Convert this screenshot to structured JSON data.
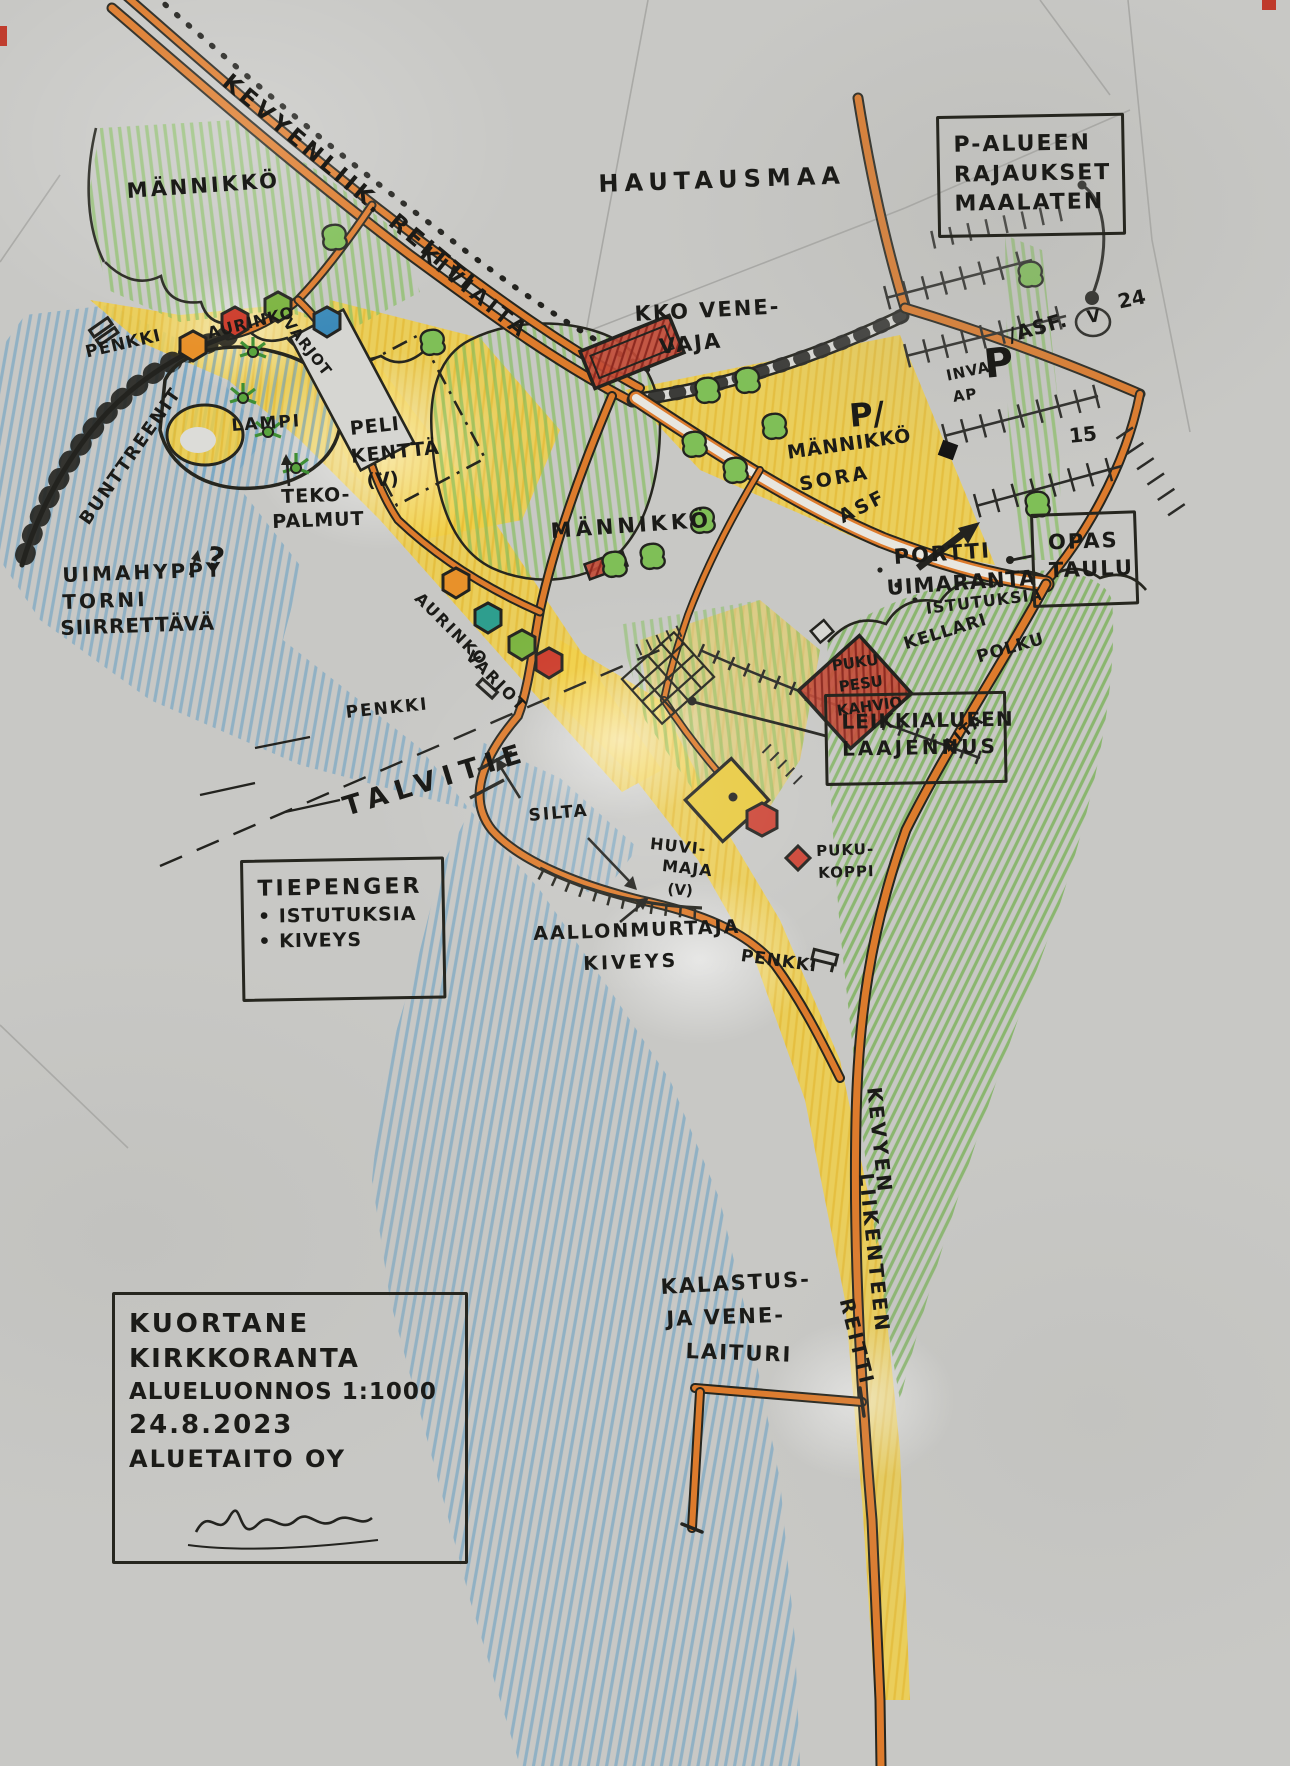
{
  "page": {
    "type": "hand-drawn landscape sketch plan (scanned colour pencil drawing)",
    "language": "Finnish"
  },
  "colors": {
    "paper": "#c8c8c5",
    "road_orange": "#dd7b2c",
    "water_blue": "#6fa3c4",
    "sand_yellow": "#f2cf43",
    "grass_green": "#84bd5c",
    "tree_green": "#7fbf57",
    "building_red": "#bf3a2b",
    "ink_black": "#23231f"
  },
  "labels": [
    {
      "id": "kevyenliik-reitti",
      "text": "KEVYENLIIK. REITTI",
      "x": 233,
      "y": 70,
      "rot": 40,
      "size": 23,
      "ls": 4
    },
    {
      "id": "mannikko-nw",
      "text": "MÄNNIKKÖ",
      "x": 126,
      "y": 180,
      "rot": -4,
      "size": 21,
      "ls": 3
    },
    {
      "id": "hautausmaa",
      "text": "HAUTAUSMAA",
      "x": 598,
      "y": 172,
      "rot": -2,
      "size": 24,
      "ls": 6
    },
    {
      "id": "kiviaita",
      "text": "KIVIAITA",
      "x": 430,
      "y": 242,
      "rot": 39,
      "size": 21,
      "ls": 4
    },
    {
      "id": "kko-venevaja-line1",
      "text": "KKO VENE-",
      "x": 634,
      "y": 303,
      "rot": -3,
      "size": 21,
      "ls": 2
    },
    {
      "id": "kko-venevaja-line2",
      "text": "VAJA",
      "x": 658,
      "y": 336,
      "rot": -6,
      "size": 21,
      "ls": 2
    },
    {
      "id": "penkki-nw",
      "text": "PENKKI",
      "x": 84,
      "y": 345,
      "rot": -13,
      "size": 17,
      "ls": 1
    },
    {
      "id": "aurinkovarjot-nw-1",
      "text": "AURINKO",
      "x": 206,
      "y": 326,
      "rot": -14,
      "size": 16,
      "ls": 1
    },
    {
      "id": "aurinkovarjot-nw-2",
      "text": "VARJOT",
      "x": 292,
      "y": 316,
      "rot": 52,
      "size": 15,
      "ls": 1
    },
    {
      "id": "lampi",
      "text": "LAMPI",
      "x": 231,
      "y": 418,
      "rot": -4,
      "size": 17,
      "ls": 2
    },
    {
      "id": "pelikentta-1",
      "text": "PELI",
      "x": 349,
      "y": 420,
      "rot": -6,
      "size": 19,
      "ls": 1
    },
    {
      "id": "pelikentta-2",
      "text": "KENTTÄ",
      "x": 350,
      "y": 448,
      "rot": -6,
      "size": 19,
      "ls": 1
    },
    {
      "id": "pelikentta-3",
      "text": "(V)",
      "x": 366,
      "y": 472,
      "rot": -4,
      "size": 19,
      "ls": 0
    },
    {
      "id": "tekopalmut-1",
      "text": "TEKO-",
      "x": 281,
      "y": 488,
      "rot": -2,
      "size": 19,
      "ls": 1
    },
    {
      "id": "tekopalmut-2",
      "text": "PALMUT",
      "x": 272,
      "y": 513,
      "rot": -2,
      "size": 19,
      "ls": 1
    },
    {
      "id": "uimahyppy-1",
      "text": "UIMAHYPPY",
      "x": 62,
      "y": 565,
      "rot": -2,
      "size": 20,
      "ls": 3
    },
    {
      "id": "uimahyppy-2",
      "text": "TORNI",
      "x": 62,
      "y": 592,
      "rot": -2,
      "size": 20,
      "ls": 3
    },
    {
      "id": "uimahyppy-3",
      "text": "SIIRRETTÄVÄ",
      "x": 60,
      "y": 618,
      "rot": -2,
      "size": 20,
      "ls": 1
    },
    {
      "id": "uimahyppy-question",
      "text": "?",
      "x": 210,
      "y": 542,
      "rot": 12,
      "size": 30,
      "ls": 0
    },
    {
      "id": "bunttreenit",
      "text": "BUNTTREENIT",
      "x": 77,
      "y": 518,
      "rot": -55,
      "size": 18,
      "ls": 2
    },
    {
      "id": "mannikko-center",
      "text": "MÄNNIKKÖ",
      "x": 550,
      "y": 520,
      "rot": -4,
      "size": 21,
      "ls": 4
    },
    {
      "id": "aurinkovarjot-beach-1",
      "text": "AURINKO",
      "x": 423,
      "y": 590,
      "rot": 45,
      "size": 16,
      "ls": 2
    },
    {
      "id": "aurinkovarjot-beach-2",
      "text": "VARJOT",
      "x": 474,
      "y": 648,
      "rot": 45,
      "size": 16,
      "ls": 2
    },
    {
      "id": "penkki-center",
      "text": "PENKKI",
      "x": 345,
      "y": 705,
      "rot": -6,
      "size": 17,
      "ls": 2
    },
    {
      "id": "talvitie",
      "text": "TALVITIE",
      "x": 340,
      "y": 795,
      "rot": -17,
      "size": 27,
      "ls": 8
    },
    {
      "id": "silta",
      "text": "SILTA",
      "x": 528,
      "y": 808,
      "rot": -5,
      "size": 17,
      "ls": 2
    },
    {
      "id": "huvimaja-1",
      "text": "HUVI-",
      "x": 651,
      "y": 836,
      "rot": 6,
      "size": 16,
      "ls": 1
    },
    {
      "id": "huvimaja-2",
      "text": "MAJA",
      "x": 663,
      "y": 858,
      "rot": 6,
      "size": 16,
      "ls": 1
    },
    {
      "id": "huvimaja-3",
      "text": "(V)",
      "x": 668,
      "y": 882,
      "rot": 4,
      "size": 15,
      "ls": 0
    },
    {
      "id": "pukukoppi-1",
      "text": "PUKU-",
      "x": 816,
      "y": 844,
      "rot": -2,
      "size": 15,
      "ls": 1
    },
    {
      "id": "pukukoppi-2",
      "text": "KOPPI",
      "x": 818,
      "y": 866,
      "rot": -2,
      "size": 15,
      "ls": 1
    },
    {
      "id": "aallonmurtaja-1",
      "text": "AALLONMURTAJA",
      "x": 533,
      "y": 925,
      "rot": -2,
      "size": 19,
      "ls": 2
    },
    {
      "id": "aallonmurtaja-2",
      "text": "KIVEYS",
      "x": 583,
      "y": 955,
      "rot": -2,
      "size": 19,
      "ls": 3
    },
    {
      "id": "penkki-beach",
      "text": "PENKKI",
      "x": 742,
      "y": 948,
      "rot": 8,
      "size": 17,
      "ls": 1
    },
    {
      "id": "mannikko-sora-1",
      "text": "MÄNNIKKÖ",
      "x": 786,
      "y": 444,
      "rot": -8,
      "size": 19,
      "ls": 1
    },
    {
      "id": "mannikko-sora-2",
      "text": "SORA",
      "x": 798,
      "y": 476,
      "rot": -10,
      "size": 19,
      "ls": 3
    },
    {
      "id": "p-sora",
      "text": "P/",
      "x": 848,
      "y": 400,
      "rot": -5,
      "size": 32,
      "bold": true
    },
    {
      "id": "inva-1",
      "text": "INVA",
      "x": 945,
      "y": 369,
      "rot": -12,
      "size": 15,
      "ls": 1
    },
    {
      "id": "inva-2",
      "text": "AP",
      "x": 952,
      "y": 390,
      "rot": -8,
      "size": 15,
      "ls": 1
    },
    {
      "id": "p-main",
      "text": "P",
      "x": 982,
      "y": 344,
      "rot": -6,
      "size": 40,
      "bold": true
    },
    {
      "id": "asf-v",
      "text": "/ASF.",
      "x": 1006,
      "y": 326,
      "rot": -16,
      "size": 20,
      "ls": 1
    },
    {
      "id": "v-circled",
      "text": "V",
      "x": 1086,
      "y": 310,
      "rot": -8,
      "size": 17,
      "ls": 0
    },
    {
      "id": "v24-count",
      "text": "24",
      "x": 1116,
      "y": 292,
      "rot": -12,
      "size": 20,
      "ls": 0
    },
    {
      "id": "parking-15-count",
      "text": "15",
      "x": 1068,
      "y": 426,
      "rot": -6,
      "size": 20,
      "ls": 0
    },
    {
      "id": "asf-street",
      "text": "ASF",
      "x": 836,
      "y": 510,
      "rot": -27,
      "size": 19,
      "ls": 3
    },
    {
      "id": "portti",
      "text": "PORTTI",
      "x": 893,
      "y": 546,
      "rot": -4,
      "size": 21,
      "ls": 2
    },
    {
      "id": "uimaranta",
      "text": "UIMARANTA",
      "x": 886,
      "y": 577,
      "rot": -4,
      "size": 21,
      "ls": 1
    },
    {
      "id": "istutuksia",
      "text": "ISTUTUKSIA",
      "x": 925,
      "y": 601,
      "rot": -7,
      "size": 16,
      "ls": 1
    },
    {
      "id": "kellari",
      "text": "KELLARI",
      "x": 902,
      "y": 637,
      "rot": -17,
      "size": 17,
      "ls": 1
    },
    {
      "id": "polku",
      "text": "POLKU",
      "x": 975,
      "y": 650,
      "rot": -16,
      "size": 17,
      "ls": 1
    },
    {
      "id": "puku-pesu-1",
      "text": "PUKU",
      "x": 831,
      "y": 659,
      "rot": -8,
      "size": 15,
      "ls": 0
    },
    {
      "id": "puku-pesu-2",
      "text": "PESU",
      "x": 838,
      "y": 680,
      "rot": -8,
      "size": 15,
      "ls": 0
    },
    {
      "id": "puku-pesu-3",
      "text": "KAHVIO",
      "x": 836,
      "y": 704,
      "rot": -8,
      "size": 15,
      "ls": 0
    },
    {
      "id": "aita",
      "text": "AITA",
      "x": 940,
      "y": 742,
      "rot": -40,
      "size": 16,
      "ls": 2
    },
    {
      "id": "kevyen-liikenteen-1",
      "text": "KEVYEN",
      "x": 884,
      "y": 1086,
      "rot": 84,
      "size": 20,
      "ls": 3
    },
    {
      "id": "kevyen-liikenteen-2",
      "text": "LIIKENTEEN",
      "x": 876,
      "y": 1172,
      "rot": 84,
      "size": 20,
      "ls": 3
    },
    {
      "id": "kevyen-liikenteen-3",
      "text": "REITTI",
      "x": 856,
      "y": 1296,
      "rot": 76,
      "size": 20,
      "ls": 3
    },
    {
      "id": "kalastuslaituri-1",
      "text": "KALASTUS-",
      "x": 660,
      "y": 1276,
      "rot": -3,
      "size": 21,
      "ls": 2
    },
    {
      "id": "kalastuslaituri-2",
      "text": "JA VENE-",
      "x": 666,
      "y": 1308,
      "rot": -2,
      "size": 21,
      "ls": 2
    },
    {
      "id": "kalastuslaituri-3",
      "text": "LAITURI",
      "x": 686,
      "y": 1340,
      "rot": 2,
      "size": 21,
      "ls": 2
    }
  ],
  "boxes": [
    {
      "id": "callout-p-alueen",
      "x": 936,
      "y": 116,
      "w": 188,
      "h": 122,
      "rot": -1,
      "lines": [
        {
          "text": "P-ALUEEN",
          "size": 22,
          "ls": 2
        },
        {
          "text": "RAJAUKSET",
          "size": 22,
          "ls": 2
        },
        {
          "text": "MAALATEN",
          "size": 22,
          "ls": 2
        }
      ]
    },
    {
      "id": "callout-opastaulu",
      "x": 1030,
      "y": 514,
      "w": 106,
      "h": 94,
      "rot": -2,
      "lines": [
        {
          "text": "OPAS",
          "size": 21,
          "ls": 2
        },
        {
          "text": "TAULU",
          "size": 21,
          "ls": 2
        }
      ]
    },
    {
      "id": "callout-leikkialue",
      "x": 824,
      "y": 694,
      "w": 182,
      "h": 92,
      "rot": -1,
      "lines": [
        {
          "text": "LEIKKIALUEEN",
          "size": 20,
          "ls": 1
        },
        {
          "text": "LAAJENNUS",
          "size": 20,
          "ls": 3
        }
      ]
    },
    {
      "id": "callout-tiepenger",
      "x": 240,
      "y": 860,
      "w": 204,
      "h": 142,
      "rot": -1,
      "lines": [
        {
          "text": "TIEPENGER",
          "size": 22,
          "ls": 3
        },
        {
          "text": "• ISTUTUKSIA",
          "size": 19,
          "ls": 1
        },
        {
          "text": "• KIVEYS",
          "size": 19,
          "ls": 1
        }
      ]
    },
    {
      "id": "title-block",
      "x": 112,
      "y": 1292,
      "w": 356,
      "h": 272,
      "rot": 0,
      "lines": [
        {
          "text": "KUORTANE",
          "size": 26,
          "ls": 3
        },
        {
          "text": "KIRKKORANTA",
          "size": 26,
          "ls": 2
        },
        {
          "text": "ALUELUONNOS 1:1000",
          "size": 23,
          "ls": 1
        },
        {
          "text": "24.8.2023",
          "size": 26,
          "ls": 2
        },
        {
          "text": "ALUETAITO OY",
          "size": 24,
          "ls": 2
        }
      ]
    }
  ]
}
